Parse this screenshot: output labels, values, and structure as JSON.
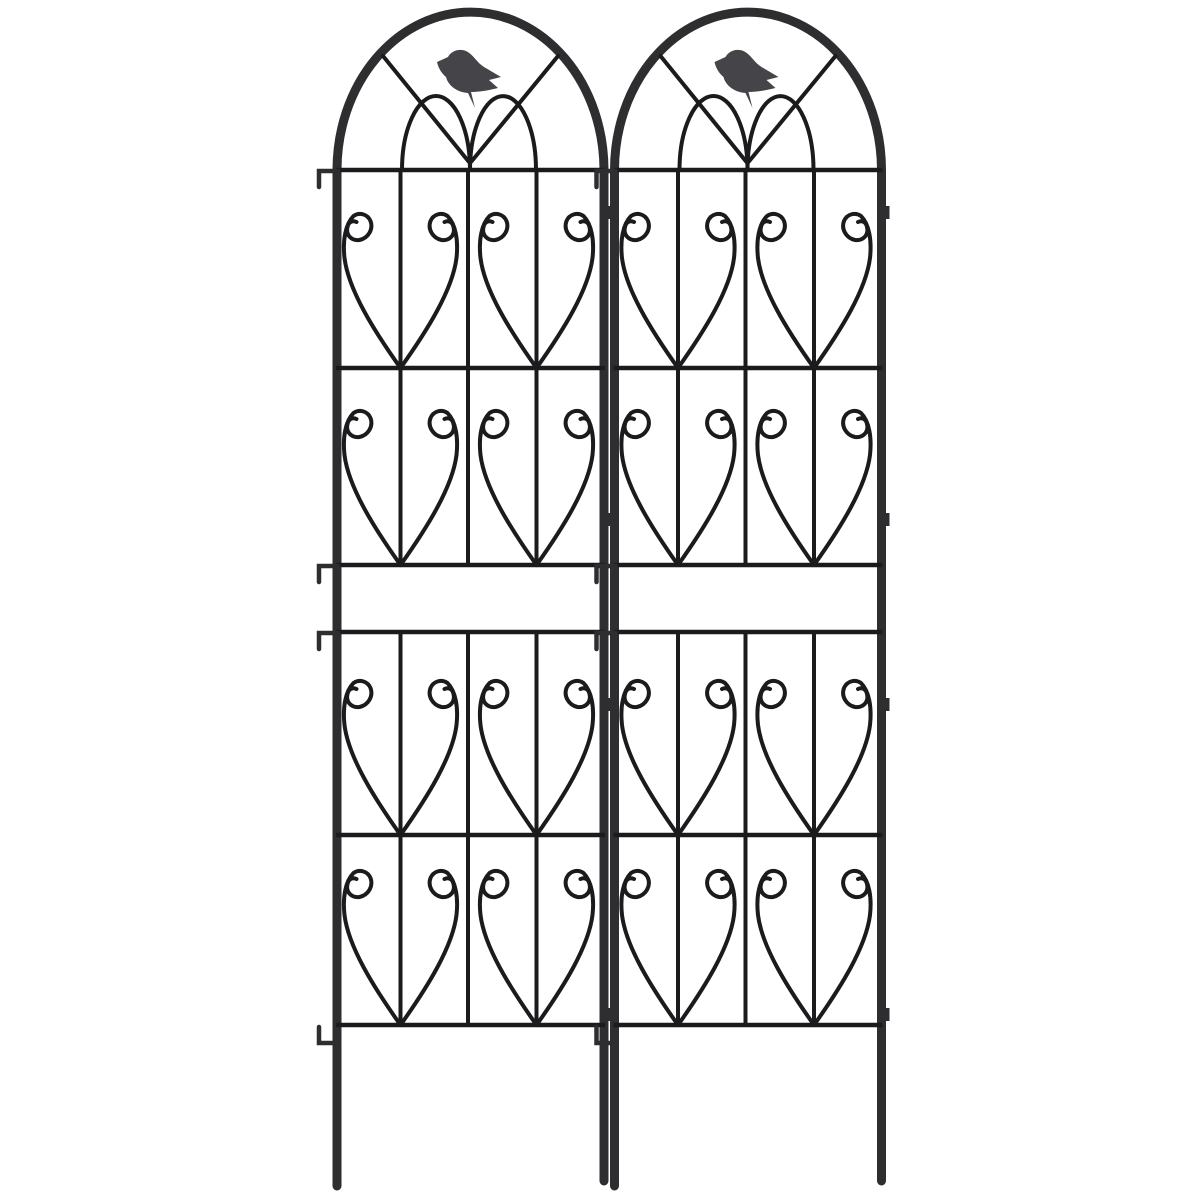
{
  "scene": {
    "description": "Two identical black wrought-iron style garden trellis panels standing side by side on white background. Each panel has a tall arched top crowned with a small perched bird silhouette over gothic double-arch tracery, four rows of paired downward-pointing scroll-heart motifs separated by horizontal rails, a blank banner band between the upper and lower motif rows, attachment hooks on the left frame edge, small tabs on the right frame edge, and two long ground-stake legs.",
    "background_color": "#ffffff",
    "panel_count": 2,
    "panels": [
      {
        "id": "left",
        "bird_count": 1
      },
      {
        "id": "right",
        "bird_count": 1
      }
    ],
    "colors": {
      "frame": "#2e2e31",
      "wire": "#1b1b1d",
      "bird": "#454549"
    },
    "motifs": {
      "rows_per_panel": 4,
      "hearts_per_row": 2,
      "scroll_hearts_per_panel": 8,
      "inner_arches_per_panel": 2,
      "diagonal_spokes_per_panel": 2,
      "hooks_per_panel": 4,
      "tabs_per_panel": 4,
      "legs_per_panel": 2
    }
  }
}
